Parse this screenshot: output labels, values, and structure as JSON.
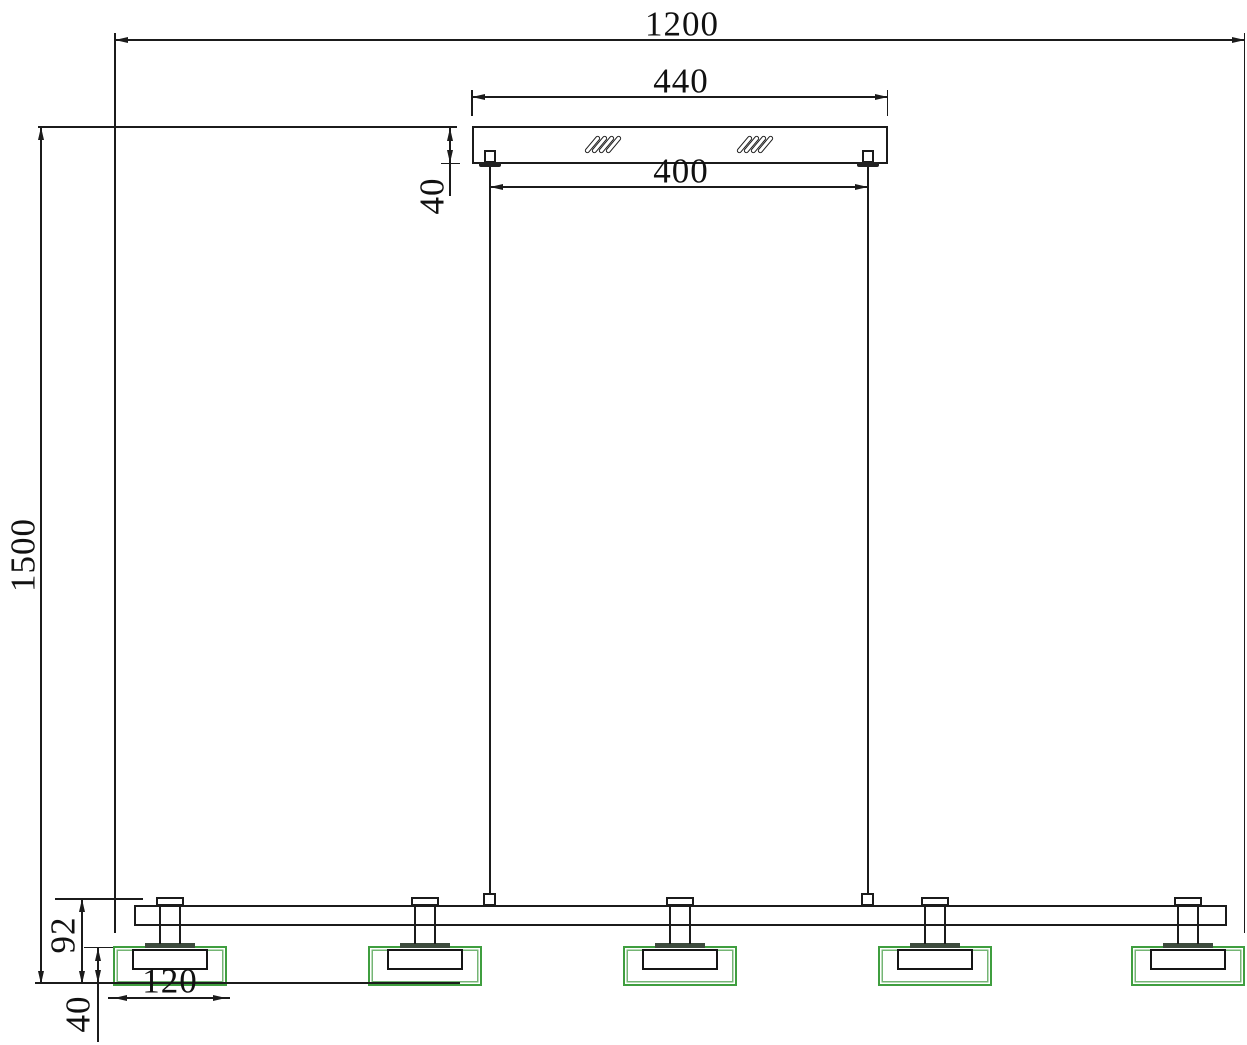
{
  "drawing": {
    "subject": "Linear pendant lamp installation drawing - front elevation",
    "lamp_head_count": 5,
    "suspension_wire_count": 2,
    "background": "#ffffff",
    "line_color": "#1b1b1b",
    "shade_outline_color": "#3f9e3f",
    "shade_inner_line_color": "#74b574",
    "flange_color": "#3d4b3d",
    "hatch_symbol": "diagonal-slash-marks"
  },
  "dims": {
    "overall_width": "1200",
    "canopy_width": "440",
    "wire_spacing": "400",
    "canopy_height": "40",
    "drop_height": "1500",
    "head_height": "92",
    "shade_height": "40",
    "shade_width": "120"
  }
}
